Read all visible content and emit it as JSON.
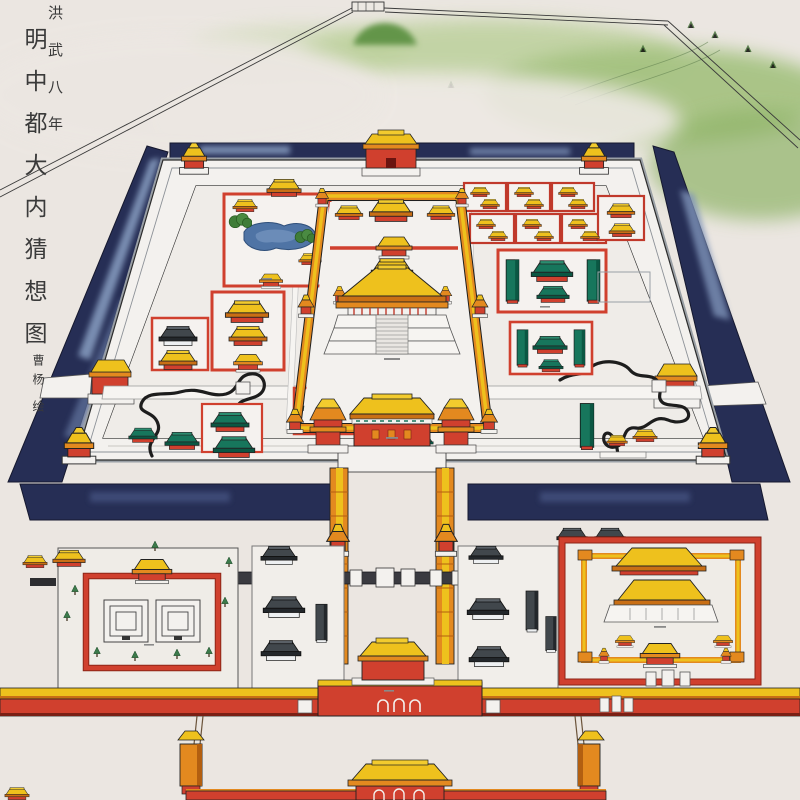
{
  "artwork": {
    "era_inscription": "洪武八年",
    "title": "明中都大内猜想图",
    "artist_signature": "曹杨",
    "artist_verb": "绘"
  },
  "palette": {
    "paper": "#ebe6e1",
    "moat_navy": "#262e55",
    "moat_reflection": "#8fa6c9",
    "wall_white": "#f3f1ee",
    "wall_gray_top": "#9aa0a6",
    "wall_red": "#d0402e",
    "wall_red_dark": "#8e2417",
    "roof_yellow": "#eec11d",
    "roof_yellow_light": "#f2cb2e",
    "roof_orange": "#e3891f",
    "roof_orange_dark": "#c96f15",
    "roof_green": "#17765c",
    "roof_green_dark": "#0b5743",
    "roof_gray": "#41474c",
    "pond_blue": "#4f74a5",
    "hill_green": "#9dbb79",
    "tree_green": "#3c7a4b",
    "street_dark": "#3a3a40",
    "stream_ink": "#1d1d1d",
    "ink": "#2a2a2a"
  }
}
